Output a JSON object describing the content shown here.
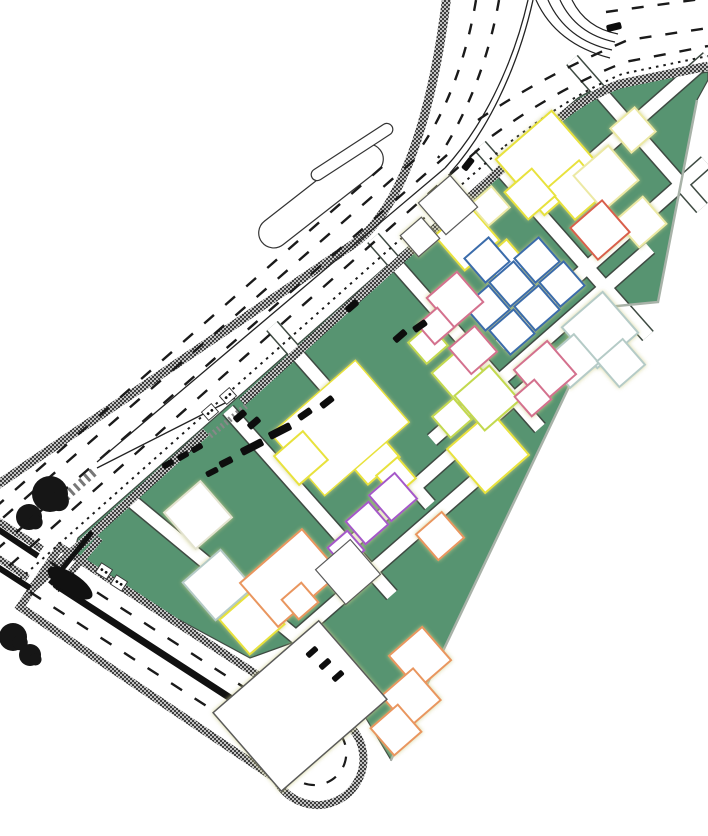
{
  "meta": {
    "description": "CAD master-plan site drawing: curved arterial road with hatched edge bands and dashed lane markings, a wedge-shaped green development parcel with diagonal white path grid, colored building plot outlines, lower divided boulevard ending in a U-turn loop, street trees and parked vehicles",
    "canvas": {
      "width": 708,
      "height": 836
    }
  },
  "palette": {
    "background": "#ffffff",
    "site_green": "#579471",
    "path_edge": "#3e4a42",
    "path_fill": "#ffffff",
    "boundary_shadow": "#a8b2a8",
    "band_base": "#c2c2c2",
    "band_dot": "#3e3e3e",
    "marking": "#1a1a1a",
    "asphalt_black": "#111111",
    "vehicle": "#0d0d0d",
    "tree": "#161616"
  },
  "building_colors": {
    "yellow": "#e8e23c",
    "paleyellow": "#ece9a4",
    "yellowgreen": "#c3d94f",
    "blue": "#3a6cab",
    "paleblue": "#b5cbc7",
    "pink": "#d4718e",
    "red": "#d95f4c",
    "orange": "#e9965f",
    "purple": "#a558c9",
    "plain": "#5a5a5a",
    "faint": "#e3e3cf"
  },
  "site": {
    "outline": "M 78,538 L 516,152 Q 550,122 578,98 Q 600,84 625,84 L 708,72 L 708,80 L 697,100 L 658,302 L 607,307 L 391,760 L 355,700 L 300,640 L 250,658 L 98,576 Q 70,558 78,538 Z",
    "boundary_shadow_points": "697,100 658,302 607,307 391,760"
  },
  "paths": {
    "width": 12.5,
    "edge_width": 15.5,
    "segments": [
      [
        572,
        60,
        702,
        208
      ],
      [
        480,
        146,
        648,
        336
      ],
      [
        373,
        238,
        540,
        428
      ],
      [
        272,
        326,
        430,
        505
      ],
      [
        228,
        410,
        392,
        595
      ],
      [
        128,
        498,
        302,
        642
      ],
      [
        558,
        190,
        708,
        58
      ],
      [
        500,
        345,
        706,
        162
      ],
      [
        432,
        440,
        650,
        248
      ],
      [
        355,
        540,
        560,
        358
      ],
      [
        295,
        638,
        478,
        478
      ]
    ]
  },
  "buildings": [
    [
      548,
      163,
      74,
      74,
      "yellow"
    ],
    [
      577,
      190,
      42,
      42,
      "yellow"
    ],
    [
      530,
      194,
      36,
      36,
      "yellow"
    ],
    [
      467,
      238,
      46,
      46,
      "yellow"
    ],
    [
      505,
      262,
      32,
      32,
      "yellow"
    ],
    [
      488,
      452,
      58,
      58,
      "yellow"
    ],
    [
      370,
      455,
      42,
      42,
      "yellow"
    ],
    [
      396,
      477,
      28,
      28,
      "yellow"
    ],
    [
      340,
      428,
      112,
      82,
      "yellow",
      1.5
    ],
    [
      301,
      458,
      38,
      38,
      "yellow"
    ],
    [
      252,
      622,
      46,
      46,
      "yellow"
    ],
    [
      606,
      178,
      46,
      46,
      "paleyellow"
    ],
    [
      641,
      222,
      36,
      36,
      "paleyellow"
    ],
    [
      490,
      206,
      28,
      28,
      "paleyellow"
    ],
    [
      633,
      130,
      32,
      32,
      "paleyellow"
    ],
    [
      460,
      375,
      40,
      40,
      "yellowgreen"
    ],
    [
      487,
      398,
      46,
      46,
      "yellowgreen"
    ],
    [
      452,
      418,
      28,
      28,
      "yellowgreen"
    ],
    [
      428,
      344,
      28,
      28,
      "yellowgreen"
    ],
    [
      487,
      260,
      32,
      32,
      "blue"
    ],
    [
      512,
      284,
      32,
      32,
      "blue"
    ],
    [
      537,
      260,
      32,
      32,
      "blue"
    ],
    [
      562,
      284,
      32,
      32,
      "blue"
    ],
    [
      537,
      308,
      32,
      32,
      "blue"
    ],
    [
      512,
      332,
      32,
      32,
      "blue"
    ],
    [
      487,
      308,
      32,
      32,
      "blue"
    ],
    [
      600,
      330,
      54,
      54,
      "paleblue"
    ],
    [
      572,
      361,
      38,
      38,
      "paleblue"
    ],
    [
      621,
      363,
      34,
      34,
      "paleblue"
    ],
    [
      218,
      585,
      50,
      50,
      "paleblue"
    ],
    [
      455,
      300,
      40,
      40,
      "pink"
    ],
    [
      436,
      326,
      26,
      26,
      "pink"
    ],
    [
      473,
      350,
      34,
      34,
      "pink"
    ],
    [
      545,
      372,
      44,
      44,
      "pink"
    ],
    [
      533,
      398,
      26,
      26,
      "pink"
    ],
    [
      600,
      230,
      42,
      42,
      "red"
    ],
    [
      290,
      578,
      82,
      58,
      "orange"
    ],
    [
      440,
      536,
      34,
      34,
      "orange"
    ],
    [
      420,
      658,
      44,
      44,
      "orange"
    ],
    [
      411,
      698,
      42,
      42,
      "orange"
    ],
    [
      396,
      730,
      36,
      36,
      "orange"
    ],
    [
      300,
      601,
      26,
      26,
      "orange"
    ],
    [
      393,
      497,
      34,
      34,
      "purple"
    ],
    [
      367,
      523,
      30,
      30,
      "purple"
    ],
    [
      346,
      549,
      26,
      26,
      "purple"
    ],
    [
      448,
      205,
      42,
      42,
      "plain",
      1.2
    ],
    [
      420,
      237,
      28,
      28,
      "plain",
      1.2
    ],
    [
      348,
      572,
      46,
      46,
      "plain",
      1.2
    ],
    [
      300,
      706,
      140,
      104,
      "plain",
      1.5
    ],
    [
      198,
      515,
      48,
      48,
      "faint"
    ]
  ],
  "roads": {
    "bands": [
      {
        "d": "M 30,590 L 206,432",
        "w": 9
      },
      {
        "d": "M 242,402 L 516,156 C 550,126 575,100 620,84 L 708,66",
        "w": 9
      },
      {
        "d": "M -10,490 L 352,245 C 400,212 432,120 447,-5",
        "w": 9
      },
      {
        "d": "M -5,519 L 42,549",
        "w": 7
      },
      {
        "d": "M 100,538 L 56,590",
        "w": 7
      },
      {
        "d": "M -5,556 L 28,578",
        "w": 7
      }
    ],
    "hairpin": {
      "fill_d": "M 60,547 L 316,713 A 46 46 0 1 1 276,779 L 20,607 Z",
      "median_d": "M 56,585 L 298,742",
      "median_w": 7,
      "bulb_dash_d": "M 322,722 A 32 32 0 1 1 286,768",
      "lane_dashes": [
        "M 50,562 L 310,730",
        "M 30,592 L 290,760"
      ],
      "teardrop": {
        "cx": 70,
        "cy": 583,
        "rx": 26,
        "ry": 10,
        "rot": 33
      }
    },
    "islands": [
      {
        "cx": 321,
        "cy": 196,
        "w": 150,
        "h": 30,
        "r": 15,
        "rot": -38
      },
      {
        "cx": 352,
        "cy": 152,
        "w": 95,
        "h": 12,
        "r": 6,
        "rot": -33
      }
    ],
    "dashed": [
      {
        "d": "M 9,566 L 480,148",
        "dash": "13 15",
        "w": 2.4
      },
      {
        "d": "M -5,551 L 455,148",
        "dash": "13 15",
        "w": 2.4
      },
      {
        "d": "M -18,536 L 420,155",
        "dash": "13 15",
        "w": 2.4
      },
      {
        "d": "M -27,527 L 390,160",
        "dash": "13 15",
        "w": 2.4
      },
      {
        "d": "M 492,136 C 535,105 575,82 625,62 L 708,46",
        "dash": "12 14",
        "w": 2.4
      },
      {
        "d": "M 478,120 C 525,88 572,64 628,40 L 708,28",
        "dash": "12 14",
        "w": 2.4
      },
      {
        "d": "M 606,12 L 708,-2",
        "dash": "12 14",
        "w": 2.4
      },
      {
        "d": "M 476,0 C 467,55 448,108 422,146",
        "dash": "11 13",
        "w": 2.4
      },
      {
        "d": "M 499,0 C 489,58 467,115 438,158",
        "dash": "11 13",
        "w": 2.4
      }
    ],
    "dotted": [
      {
        "d": "M 20,579 L 506,145",
        "dash": "2.5 5",
        "w": 2
      },
      {
        "d": "M 505,146 C 545,115 580,92 622,74 L 708,56",
        "dash": "2.5 5",
        "w": 2
      }
    ],
    "thin": [
      {
        "d": "M 528,0 C 512,70 480,130 445,168",
        "w": 1.3
      },
      {
        "d": "M 533,0 C 517,72 485,134 450,173",
        "w": 1.3
      },
      {
        "d": "M 445,168 L 97,462",
        "w": 1.3
      },
      {
        "d": "M 97,468 L 235,398",
        "w": 1.3
      },
      {
        "d": "M 536,0 Q 556,44 610,58",
        "w": 1.2
      },
      {
        "d": "M 548,0 Q 566,40 612,50",
        "w": 1.2
      },
      {
        "d": "M 560,0 Q 576,34 615,42",
        "w": 1.2
      },
      {
        "d": "M 572,0 Q 586,28 618,34",
        "w": 1.2
      }
    ],
    "black_bars": [
      {
        "d": "M -4,528 L 38,556",
        "w": 6
      },
      {
        "d": "M -4,566 L 30,588",
        "w": 6
      },
      {
        "d": "M 92,532 L 50,584",
        "w": 5
      }
    ],
    "entrance_hatch": {
      "d": "M 210,436 L 246,406",
      "dash": "2 3",
      "w": 6
    },
    "zebra": {
      "d": "M 60,502 L 96,470",
      "dash": "3 4",
      "w": 9
    }
  },
  "vehicles": [
    [
      400,
      336,
      15,
      7,
      -41
    ],
    [
      420,
      326,
      15,
      7,
      -35
    ],
    [
      352,
      306,
      14,
      7,
      -41
    ],
    [
      468,
      164,
      14,
      7,
      -52
    ],
    [
      614,
      27,
      15,
      7,
      -14
    ],
    [
      252,
      447,
      24,
      8,
      -27
    ],
    [
      280,
      431,
      24,
      8,
      -27
    ],
    [
      226,
      462,
      14,
      7,
      -27
    ],
    [
      305,
      414,
      15,
      7,
      -35
    ],
    [
      327,
      402,
      15,
      7,
      -38
    ],
    [
      240,
      416,
      14,
      7,
      -41
    ],
    [
      212,
      472,
      13,
      6,
      -27
    ],
    [
      168,
      464,
      12,
      6,
      -30
    ],
    [
      183,
      456,
      12,
      6,
      -30
    ],
    [
      197,
      448,
      12,
      6,
      -30
    ],
    [
      312,
      652,
      13,
      6,
      -41
    ],
    [
      325,
      664,
      13,
      6,
      -41
    ],
    [
      338,
      676,
      13,
      6,
      -41
    ],
    [
      254,
      423,
      14,
      7,
      -41
    ]
  ],
  "trees": [
    [
      50,
      494,
      18
    ],
    [
      29,
      517,
      13
    ],
    [
      13,
      637,
      14
    ],
    [
      30,
      655,
      11
    ]
  ],
  "crossing_markers": [
    [
      104,
      571,
      33
    ],
    [
      119,
      583,
      33
    ],
    [
      228,
      396,
      -41
    ],
    [
      210,
      412,
      -41
    ]
  ]
}
